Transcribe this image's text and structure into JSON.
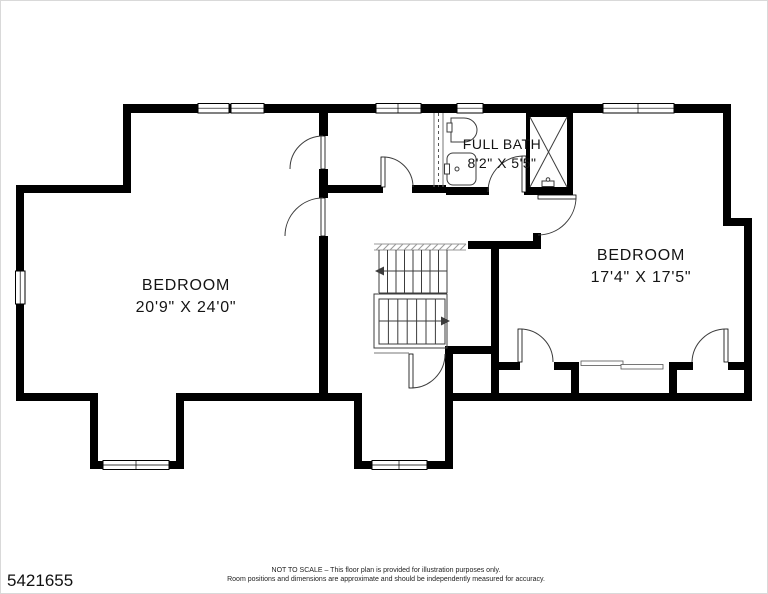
{
  "rooms": {
    "full_bath": {
      "label": "FULL BATH",
      "dims": "8'2\" X 5'5\""
    },
    "bedroom_left": {
      "label": "BEDROOM",
      "dims": "20'9\" X 24'0\""
    },
    "bedroom_right": {
      "label": "BEDROOM",
      "dims": "17'4\" X 17'5\""
    }
  },
  "footer": {
    "listing_number": "5421655",
    "disclaimer_line1": "NOT TO SCALE – This floor plan is provided for illustration purposes only.",
    "disclaimer_line2": "Room positions and dimensions are approximate and should be independently measured for accuracy."
  },
  "colors": {
    "wall": "#000000",
    "thin_line": "#3c3c3c",
    "background": "#ffffff"
  }
}
